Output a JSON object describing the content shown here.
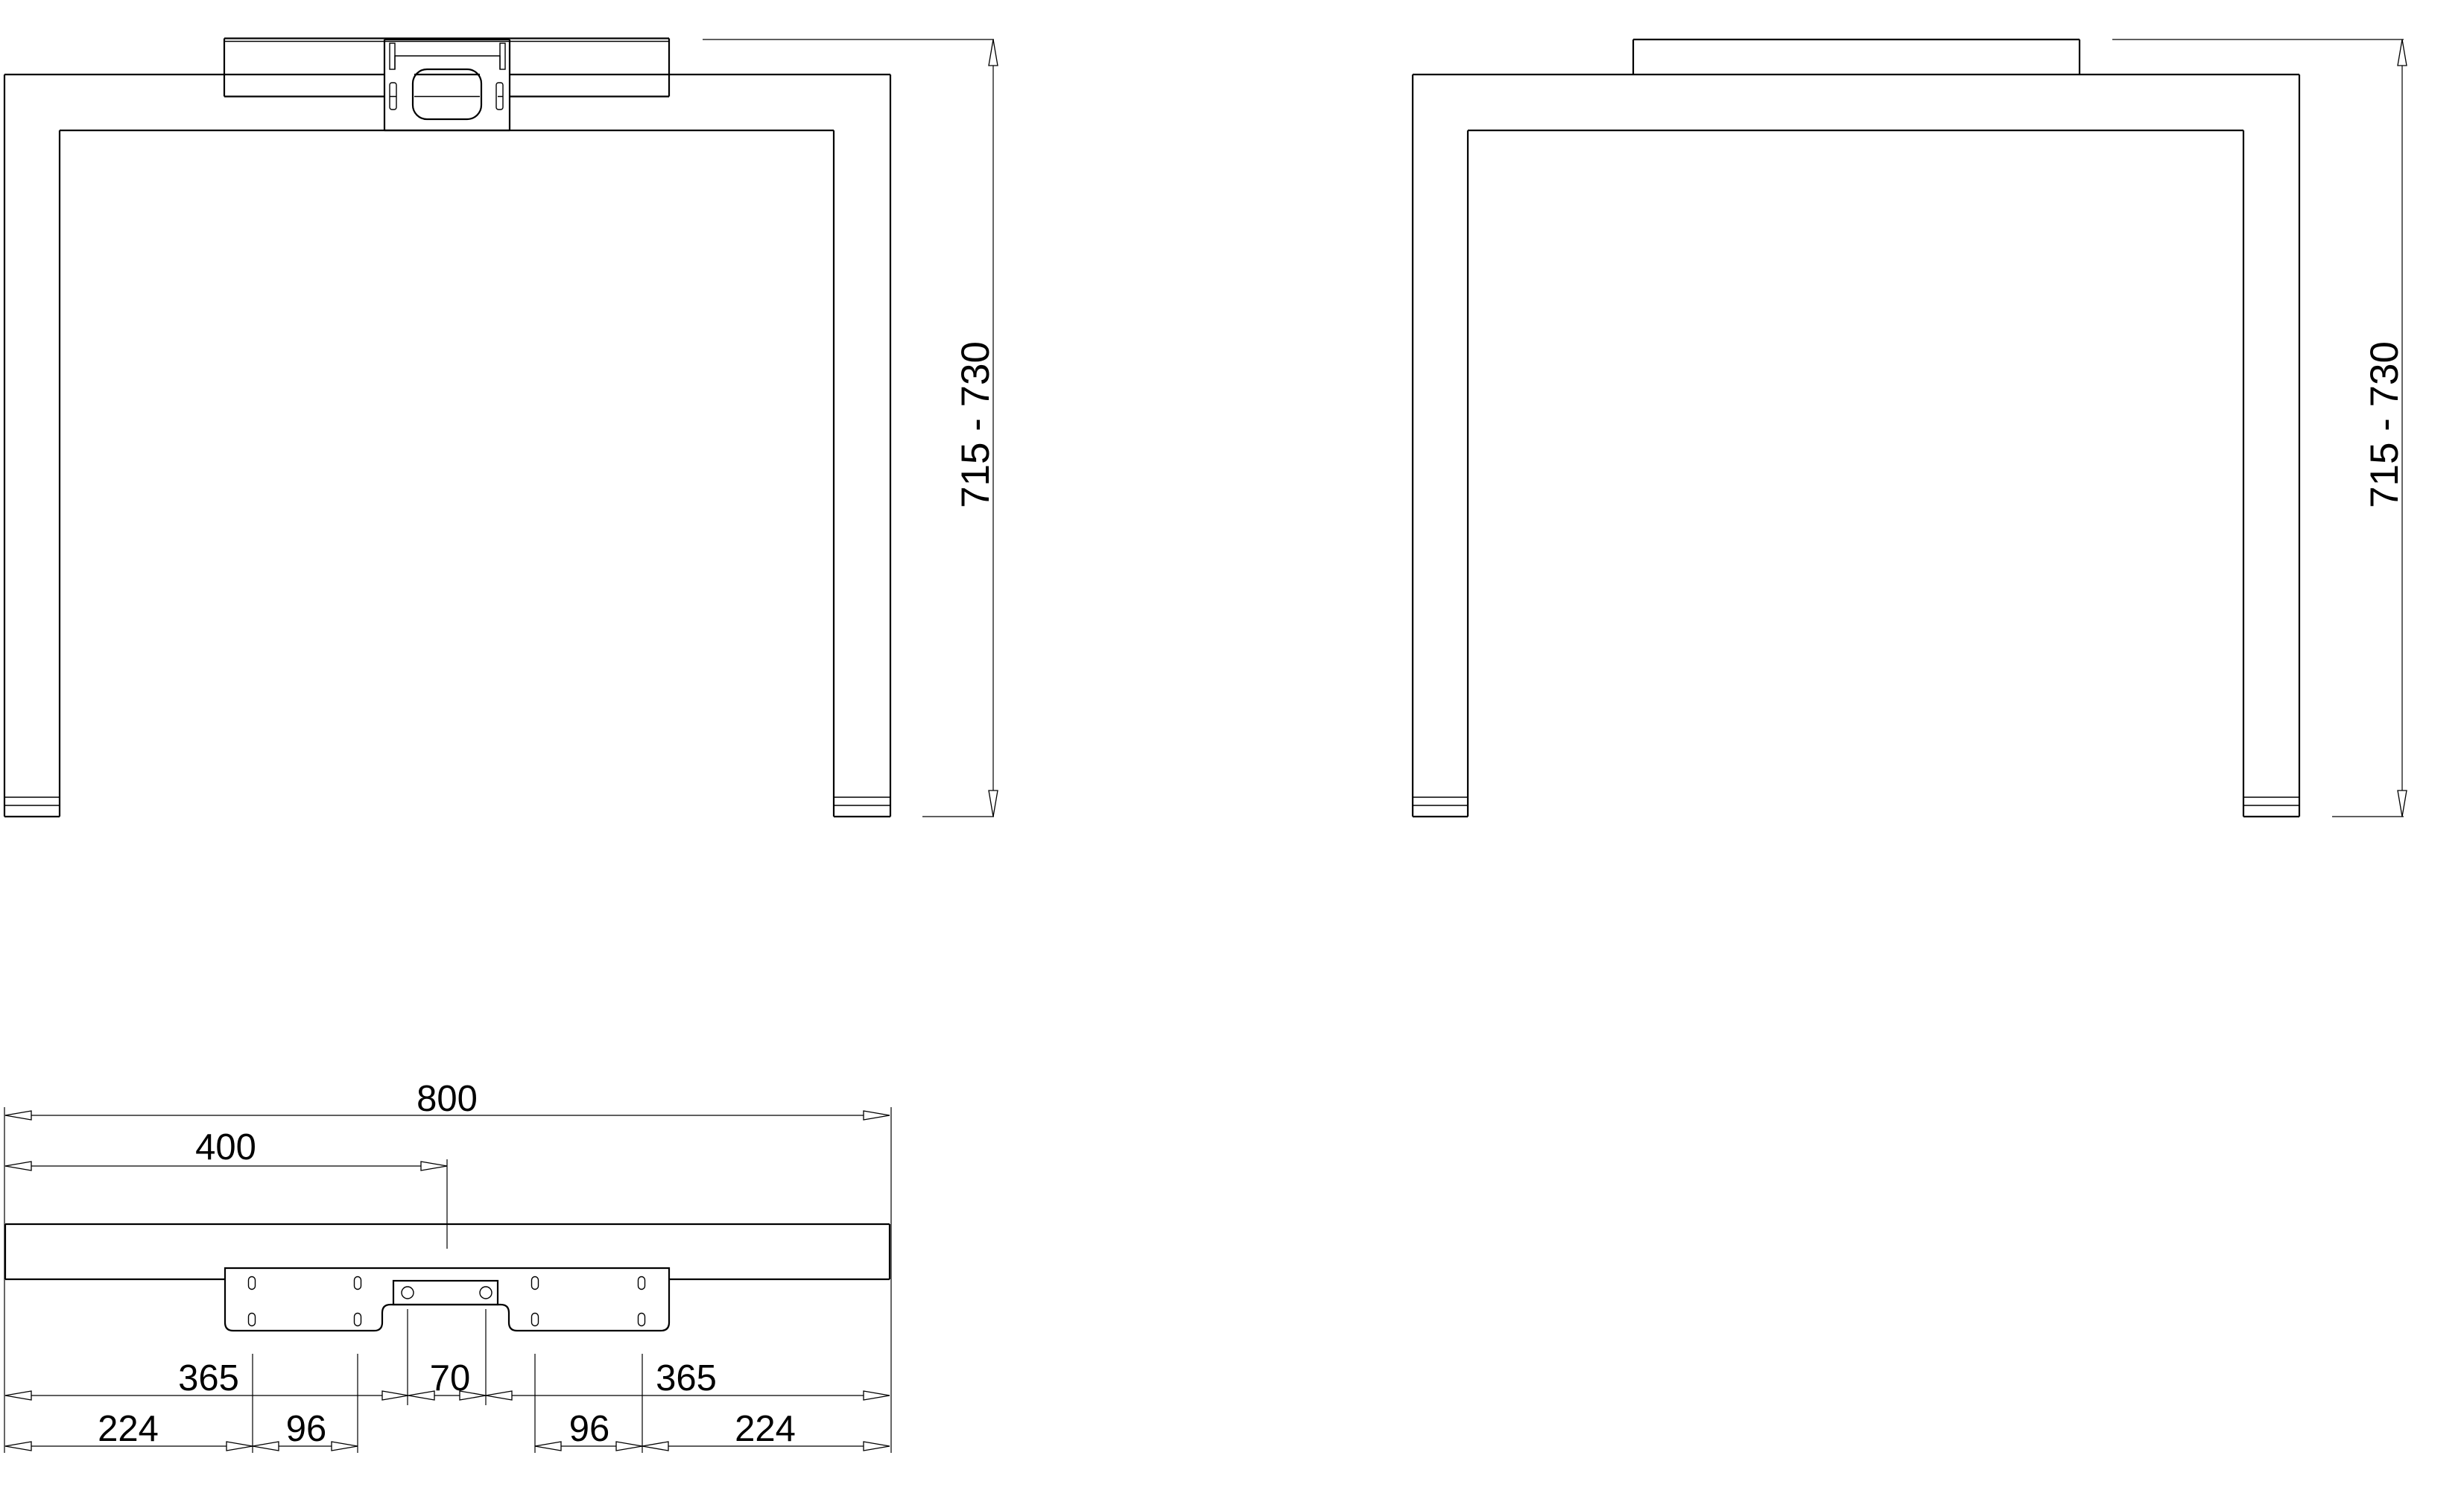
{
  "colors": {
    "background": "#ffffff",
    "line": "#000000"
  },
  "dims": {
    "height_left": "715 - 730",
    "height_right": "715 - 730",
    "overall_width": "800",
    "center_offset": "400",
    "hole_left": "365",
    "hole_spacing": "70",
    "hole_right": "365",
    "outer_left": "224",
    "inner_left": "96",
    "inner_right": "96",
    "outer_right": "224"
  }
}
